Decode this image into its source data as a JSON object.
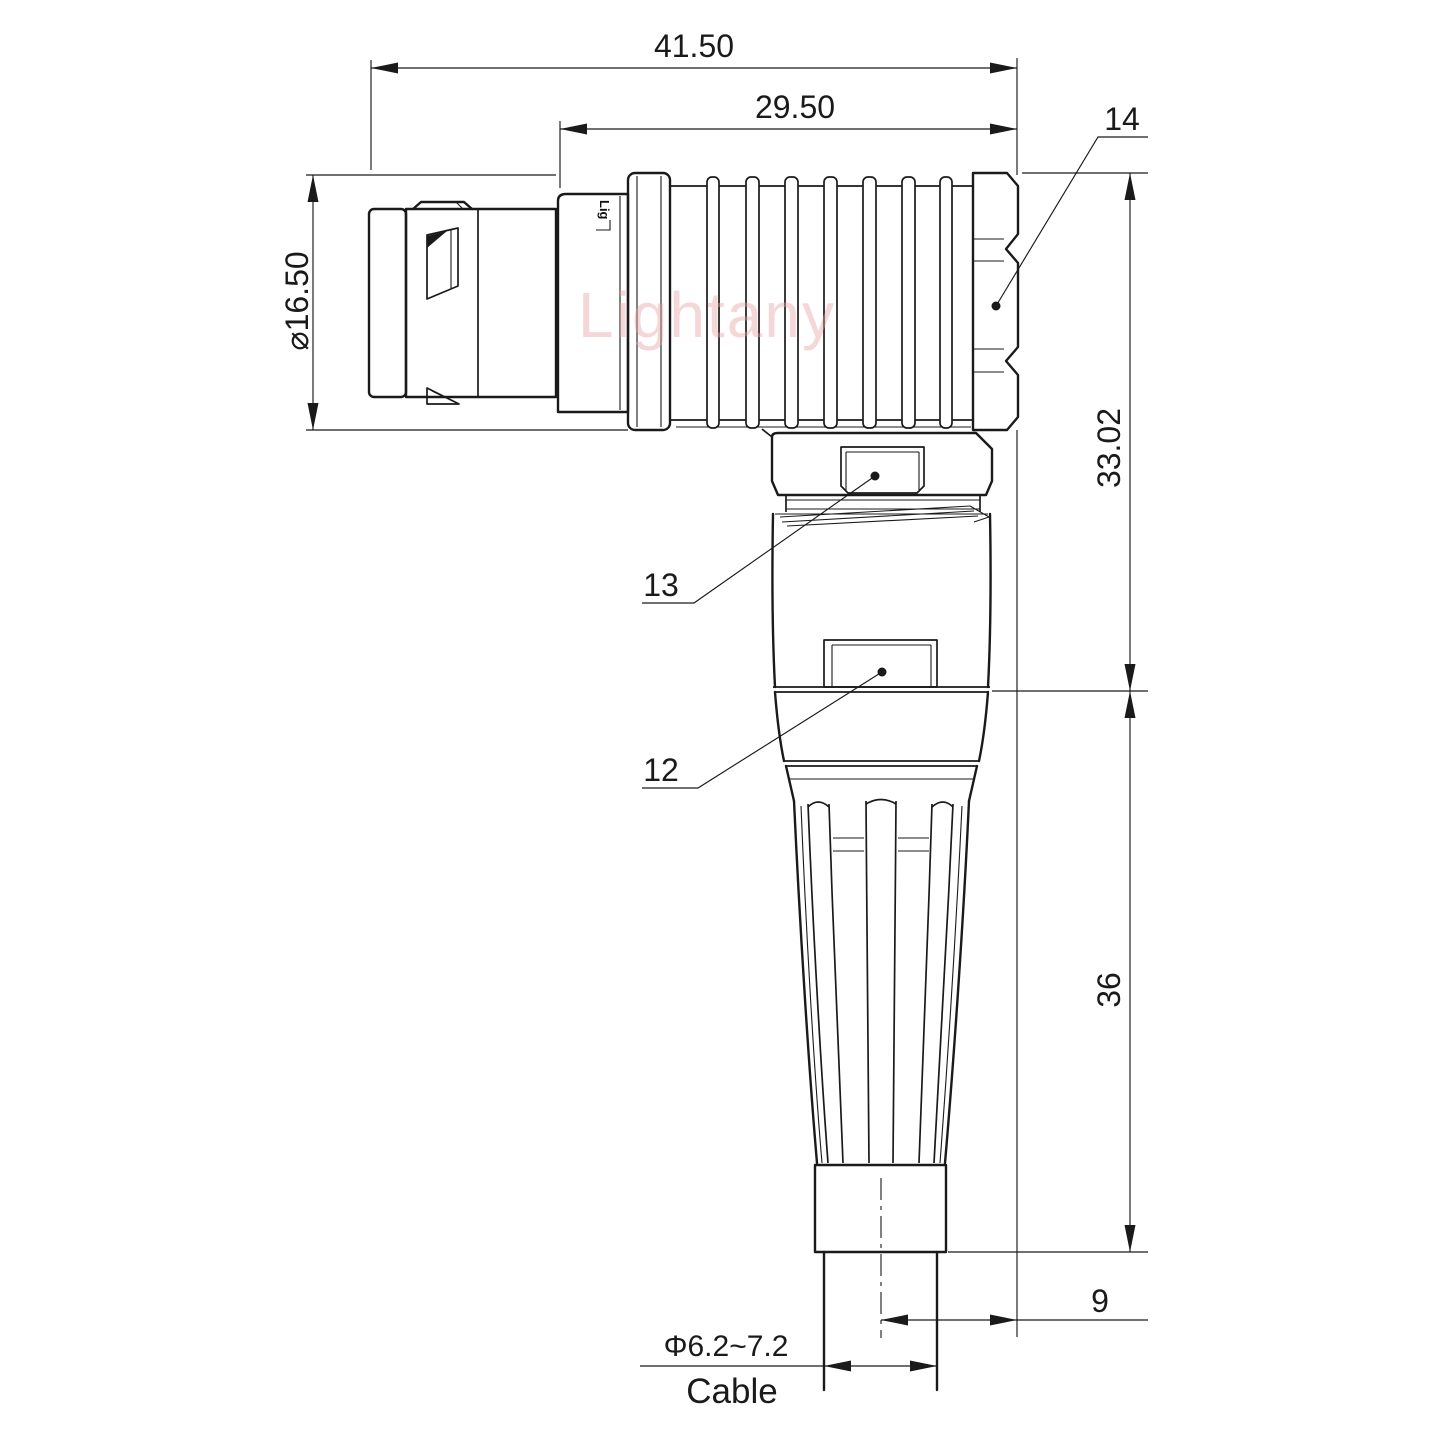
{
  "drawing": {
    "title_note": "right-angle circular push-pull connector, side elevation",
    "watermark": {
      "text": "Lightany",
      "color": "#e89f9f"
    },
    "engraving": {
      "text": "Lig"
    },
    "dims": {
      "total_length": "41.50",
      "rear_length": "29.50",
      "shell_diameter": "⌀16.50",
      "right_height_upper": "33.02",
      "right_height_lower": "36",
      "cable_axis_offset": "9",
      "cable_diameter": "Φ6.2~7.2",
      "cable_label": "Cable"
    },
    "part_labels": {
      "backnut": "14",
      "coupling_ring": "13",
      "body_sleeve": "12"
    },
    "colors": {
      "line": "#1a1a1a",
      "background": "#ffffff"
    }
  }
}
